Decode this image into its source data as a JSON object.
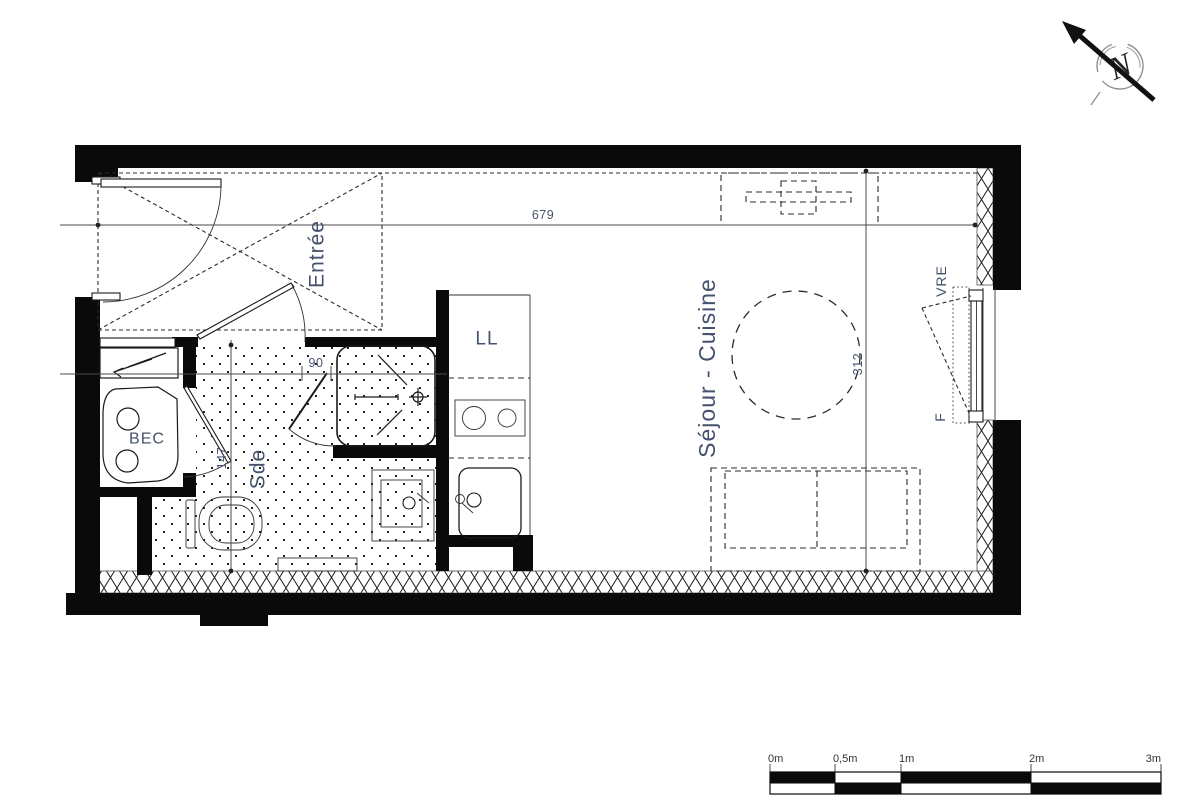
{
  "plan": {
    "rooms": {
      "entree": {
        "label": "Entrée"
      },
      "sejour": {
        "label": "Séjour - Cuisine"
      },
      "sde": {
        "label": "Sde"
      },
      "bec": {
        "label": "BEC"
      },
      "ll": {
        "label": "LL"
      }
    },
    "window": {
      "shutter_label": "VRE",
      "window_label": "F"
    },
    "dimensions": {
      "overall_width": "679",
      "overall_depth": "312",
      "sde_depth": "147",
      "door_width": "90"
    },
    "compass": {
      "north_label": "N"
    },
    "scale_bar": {
      "labels": [
        "0m",
        "0,5m",
        "1m",
        "2m",
        "3m"
      ]
    },
    "colors": {
      "wall": "#0a0a0a",
      "label_text": "#45516d",
      "background": "#ffffff"
    }
  }
}
